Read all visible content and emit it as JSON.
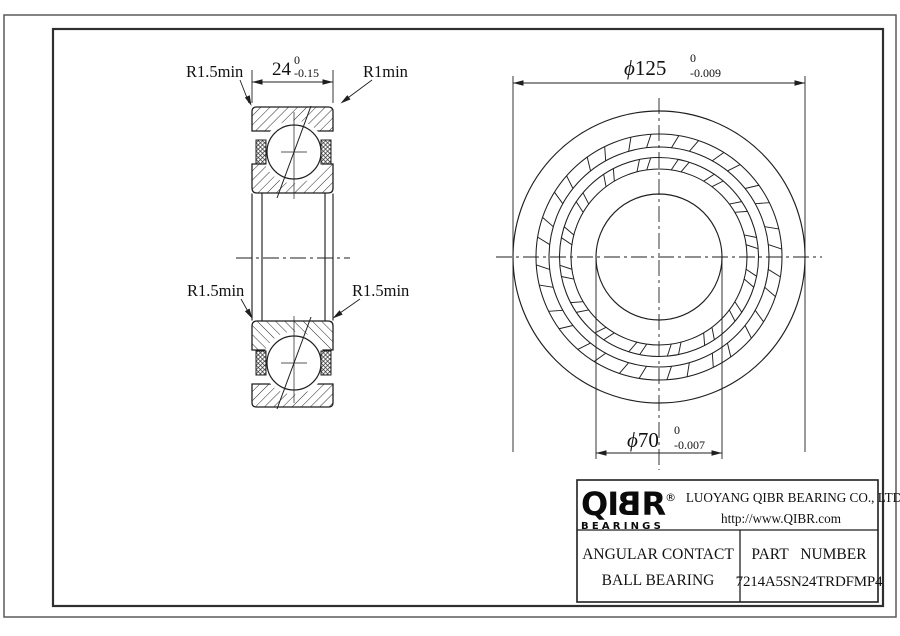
{
  "colors": {
    "line": "#1f1f1f",
    "frame": "#2f2f2f",
    "page_border": "#5a5a5a",
    "text": "#111111",
    "background": "#ffffff"
  },
  "left_view": {
    "width_dim": {
      "value": "24",
      "tol_upper": "0",
      "tol_lower": "-0.15"
    },
    "label_top_left": "R1.5min",
    "label_top_right": "R1min",
    "label_mid_left": "R1.5min",
    "label_mid_right": "R1.5min"
  },
  "right_view": {
    "od_dim": {
      "symbol": "ϕ",
      "value": "125",
      "tol_upper": "0",
      "tol_lower": "-0.009"
    },
    "bore_dim": {
      "symbol": "ϕ",
      "value": "70",
      "tol_upper": "0",
      "tol_lower": "-0.007"
    }
  },
  "title_block": {
    "logo": {
      "part1": "QI",
      "part2": "B",
      "part3": "R",
      "registered": "®",
      "subtext": "BEARINGS"
    },
    "company": "LUOYANG QIBR BEARING CO., LTD",
    "website": "http://www.QIBR.com",
    "product_line1": "ANGULAR CONTACT",
    "product_line2": "BALL BEARING",
    "part_number_label": "PART NUMBER",
    "part_number": "7214A5SN24TRDFMP4"
  }
}
